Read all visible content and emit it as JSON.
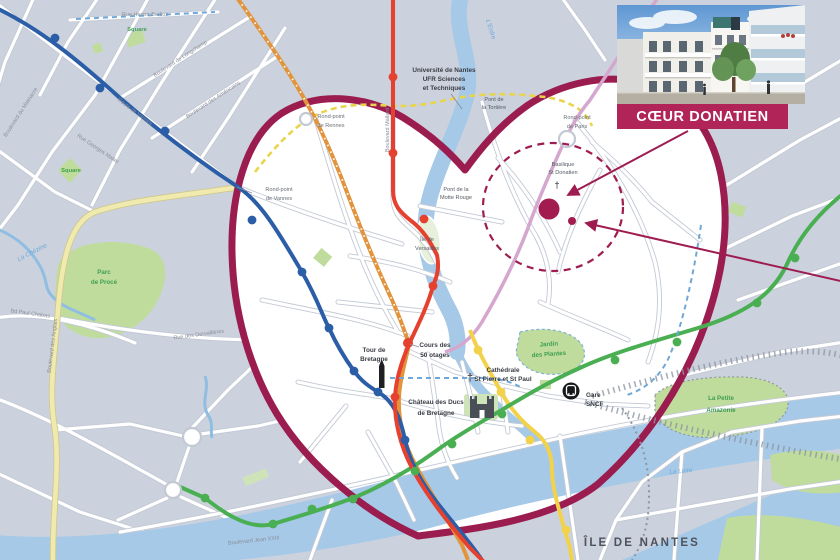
{
  "banner": {
    "title": "CŒUR DONATIEN"
  },
  "labels": {
    "universite_1": "Université de Nantes",
    "universite_2": "UFR Sciences",
    "universite_3": "et Techniques",
    "pont_tortiere_1": "Pont de",
    "pont_tortiere_2": "la Tortière",
    "pont_motte_1": "Pont de la",
    "pont_motte_2": "Motte Rouge",
    "rp_rennes_1": "Rond-point",
    "rp_rennes_2": "de Rennes",
    "rp_vannes_1": "Rond-point",
    "rp_vannes_2": "de Vannes",
    "rp_paris_1": "Rond-point",
    "rp_paris_2": "de Paris",
    "basilique_1": "Basilique",
    "basilique_2": "St Donatien",
    "ile_versailles_1": "Île de",
    "ile_versailles_2": "Versailles",
    "cours_otages_1": "Cours des",
    "cours_otages_2": "50 otages",
    "tour_bretagne_1": "Tour de",
    "tour_bretagne_2": "Bretagne",
    "chateau_1": "Château des Ducs",
    "chateau_2": "de Bretagne",
    "cathedrale_1": "Cathédrale",
    "cathedrale_2": "St Pierre et St Paul",
    "gare_1": "Gare",
    "gare_2": "SNCF",
    "jardin_1": "Jardin",
    "jardin_2": "des Plantes",
    "parc_proce_1": "Parc",
    "parc_proce_2": "de Procé",
    "amazonie_1": "La Petite",
    "amazonie_2": "Amazonie",
    "square_nw": "Square",
    "square_w": "Square",
    "ile_nantes": "ÎLE DE NANTES"
  },
  "streets": {
    "berlioz": "Rue Hector Berlioz",
    "longchamp": "Boulevard de Longchamp",
    "americains": "Boulevard des Américains",
    "massacre": "Boulevard du Massacre",
    "route_vannes": "Route de Vannes",
    "georges_mallet": "Rue Georges Mallet",
    "mallard": "Boulevard Mallard",
    "anglais": "Boulevard des Anglais",
    "dervallieres": "Rue des Dervallières",
    "paul_chabas": "Bd Paul Chabas",
    "jean_xxiii": "Boulevard Jean XXIII"
  },
  "water": {
    "erdre": "L'Erdre",
    "loire": "La Loire",
    "chezine": "La Chézine"
  },
  "icons": {
    "cross": "†"
  },
  "colors": {
    "map_bg": "#CBD2DD",
    "heart_fill": "#FFFFFF",
    "heart_outline": "#9B1C4E",
    "banner_bg": "#B02458",
    "site_marker": "#A31C50",
    "tram_red": "#E6402F",
    "tram_blue": "#2B5EA7",
    "tram_green": "#4AAF52",
    "tram_yellow": "#F2D14B",
    "line_orange": "#E2943D",
    "line_pink": "#D5A6CE",
    "ring_yellow_dashed": "#E8D44D",
    "water": "#A6C9E8",
    "park_green": "#BFDC9C"
  }
}
